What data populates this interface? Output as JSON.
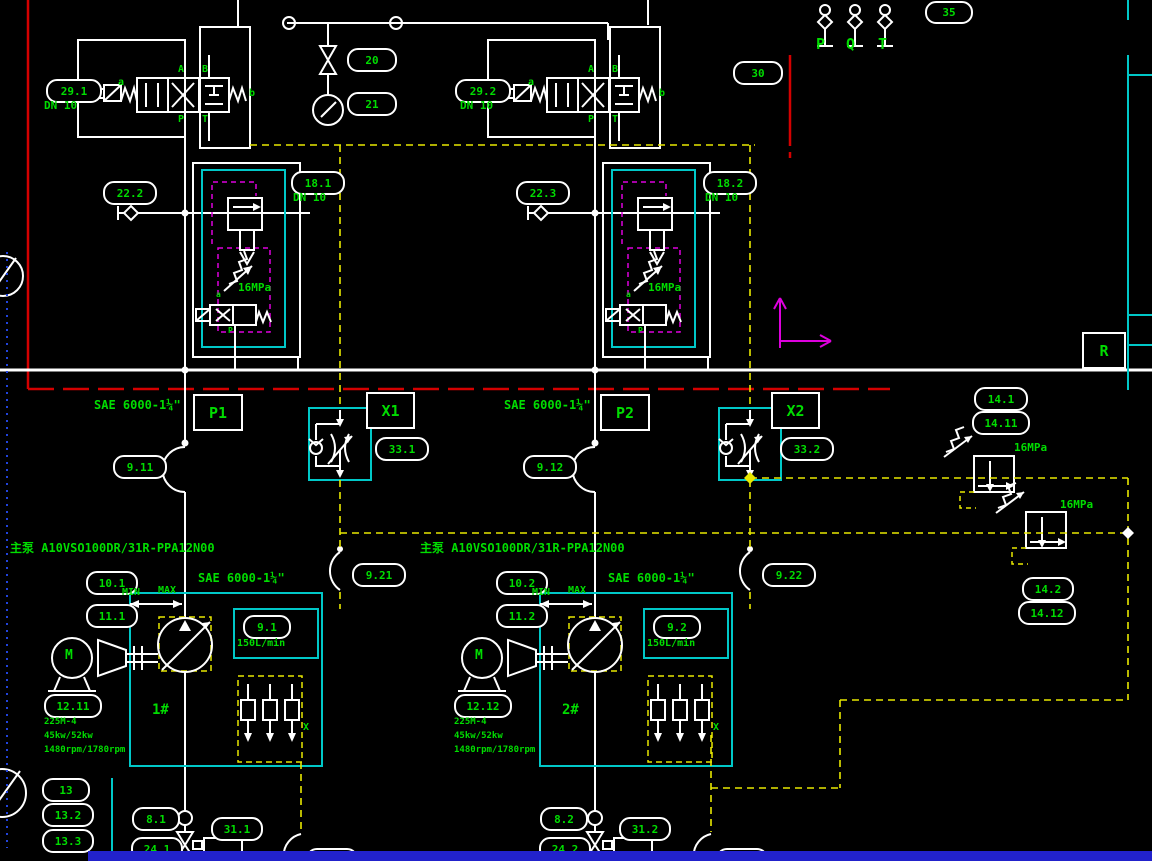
{
  "colors": {
    "background": "#000000",
    "line": "#ffffff",
    "label_green": "#00dd00",
    "cyan": "#00c8c8",
    "yellow": "#e8e800",
    "magenta": "#dd00dd",
    "red": "#d40000",
    "blue_bar": "#2222cc",
    "blue_dotted": "#2244dd"
  },
  "oval_tags": [
    {
      "id": "tag-29-1",
      "text": "29.1",
      "x": 46,
      "y": 79,
      "w": 52
    },
    {
      "id": "tag-20",
      "text": "20",
      "x": 347,
      "y": 48,
      "w": 46
    },
    {
      "id": "tag-21",
      "text": "21",
      "x": 347,
      "y": 92,
      "w": 46
    },
    {
      "id": "tag-29-2",
      "text": "29.2",
      "x": 455,
      "y": 79,
      "w": 52
    },
    {
      "id": "tag-30",
      "text": "30",
      "x": 733,
      "y": 61,
      "w": 46
    },
    {
      "id": "tag-35",
      "text": "35",
      "x": 925,
      "y": 1,
      "w": 44,
      "h": 19
    },
    {
      "id": "tag-22-2",
      "text": "22.2",
      "x": 103,
      "y": 181,
      "w": 50
    },
    {
      "id": "tag-18-1",
      "text": "18.1",
      "x": 291,
      "y": 171,
      "w": 50
    },
    {
      "id": "tag-22-3",
      "text": "22.3",
      "x": 516,
      "y": 181,
      "w": 50
    },
    {
      "id": "tag-18-2",
      "text": "18.2",
      "x": 703,
      "y": 171,
      "w": 50
    },
    {
      "id": "tag-14-1",
      "text": "14.1",
      "x": 974,
      "y": 387,
      "w": 50
    },
    {
      "id": "tag-14-11",
      "text": "14.11",
      "x": 972,
      "y": 411,
      "w": 54
    },
    {
      "id": "tag-33-1",
      "text": "33.1",
      "x": 375,
      "y": 437,
      "w": 50
    },
    {
      "id": "tag-33-2",
      "text": "33.2",
      "x": 780,
      "y": 437,
      "w": 50
    },
    {
      "id": "tag-9-11",
      "text": "9.11",
      "x": 113,
      "y": 455,
      "w": 50
    },
    {
      "id": "tag-9-12",
      "text": "9.12",
      "x": 523,
      "y": 455,
      "w": 50
    },
    {
      "id": "tag-9-21",
      "text": "9.21",
      "x": 352,
      "y": 563,
      "w": 50
    },
    {
      "id": "tag-9-22",
      "text": "9.22",
      "x": 762,
      "y": 563,
      "w": 50
    },
    {
      "id": "tag-10-1",
      "text": "10.1",
      "x": 86,
      "y": 571,
      "w": 48
    },
    {
      "id": "tag-11-1",
      "text": "11.1",
      "x": 86,
      "y": 604,
      "w": 48
    },
    {
      "id": "tag-10-2",
      "text": "10.2",
      "x": 496,
      "y": 571,
      "w": 48
    },
    {
      "id": "tag-11-2",
      "text": "11.2",
      "x": 496,
      "y": 604,
      "w": 48
    },
    {
      "id": "tag-9-1",
      "text": "9.1",
      "x": 243,
      "y": 615,
      "w": 44
    },
    {
      "id": "tag-9-2",
      "text": "9.2",
      "x": 653,
      "y": 615,
      "w": 44
    },
    {
      "id": "tag-12-11",
      "text": "12.11",
      "x": 44,
      "y": 694,
      "w": 54
    },
    {
      "id": "tag-12-12",
      "text": "12.12",
      "x": 454,
      "y": 694,
      "w": 54
    },
    {
      "id": "tag-14-2",
      "text": "14.2",
      "x": 1022,
      "y": 577,
      "w": 48
    },
    {
      "id": "tag-14-12",
      "text": "14.12",
      "x": 1018,
      "y": 601,
      "w": 54
    },
    {
      "id": "tag-13",
      "text": "13",
      "x": 42,
      "y": 778,
      "w": 44
    },
    {
      "id": "tag-13-2",
      "text": "13.2",
      "x": 42,
      "y": 803,
      "w": 48
    },
    {
      "id": "tag-13-3",
      "text": "13.3",
      "x": 42,
      "y": 829,
      "w": 48
    },
    {
      "id": "tag-8-1",
      "text": "8.1",
      "x": 132,
      "y": 807,
      "w": 44
    },
    {
      "id": "tag-24-1",
      "text": "24.1",
      "x": 131,
      "y": 837,
      "w": 48
    },
    {
      "id": "tag-31-1",
      "text": "31.1",
      "x": 211,
      "y": 817,
      "w": 48
    },
    {
      "id": "tag-8-2",
      "text": "8.2",
      "x": 540,
      "y": 807,
      "w": 44
    },
    {
      "id": "tag-24-2",
      "text": "24.2",
      "x": 539,
      "y": 837,
      "w": 48
    },
    {
      "id": "tag-31-2",
      "text": "31.2",
      "x": 619,
      "y": 817,
      "w": 48
    },
    {
      "id": "tag-34-1",
      "text": "34.1",
      "x": 306,
      "y": 848,
      "w": 48
    },
    {
      "id": "tag-34-2",
      "text": "34.2",
      "x": 716,
      "y": 848,
      "w": 48
    }
  ],
  "box_tags": [
    {
      "id": "port-p1",
      "text": "P1",
      "x": 193,
      "y": 394,
      "w": 46,
      "h": 33
    },
    {
      "id": "port-x1",
      "text": "X1",
      "x": 366,
      "y": 392,
      "w": 45,
      "h": 33
    },
    {
      "id": "port-p2",
      "text": "P2",
      "x": 600,
      "y": 394,
      "w": 46,
      "h": 33
    },
    {
      "id": "port-x2",
      "text": "X2",
      "x": 771,
      "y": 392,
      "w": 45,
      "h": 33
    },
    {
      "id": "port-r",
      "text": "R",
      "x": 1082,
      "y": 332,
      "w": 40,
      "h": 33
    }
  ],
  "green_texts": [
    {
      "id": "dn10-29-1",
      "text": "DN 10",
      "x": 44,
      "y": 100,
      "size": 11
    },
    {
      "id": "dn10-29-2",
      "text": "DN 10",
      "x": 460,
      "y": 100,
      "size": 11
    },
    {
      "id": "dn10-18-1",
      "text": "DN 10",
      "x": 293,
      "y": 192,
      "size": 11
    },
    {
      "id": "dn10-18-2",
      "text": "DN 10",
      "x": 705,
      "y": 192,
      "size": 11
    },
    {
      "id": "sae-p1",
      "text": "SAE 6000-1¼\"",
      "x": 94,
      "y": 399,
      "size": 12
    },
    {
      "id": "sae-p2",
      "text": "SAE 6000-1¼\"",
      "x": 504,
      "y": 399,
      "size": 12
    },
    {
      "id": "sae-s1",
      "text": "SAE 6000-1¼\"",
      "x": 198,
      "y": 572,
      "size": 12
    },
    {
      "id": "sae-s2",
      "text": "SAE 6000-1¼\"",
      "x": 608,
      "y": 572,
      "size": 12
    },
    {
      "id": "pump1-model",
      "text": "主泵 A10VSO100DR/31R-PPA12N00",
      "x": 10,
      "y": 542,
      "size": 12
    },
    {
      "id": "pump2-model",
      "text": "主泵 A10VSO100DR/31R-PPA12N00",
      "x": 420,
      "y": 542,
      "size": 12
    },
    {
      "id": "mpa-18-1",
      "text": "16MPa",
      "x": 238,
      "y": 282,
      "size": 11
    },
    {
      "id": "mpa-18-2",
      "text": "16MPa",
      "x": 648,
      "y": 282,
      "size": 11
    },
    {
      "id": "mpa-14-1",
      "text": "16MPa",
      "x": 1014,
      "y": 442,
      "size": 11
    },
    {
      "id": "mpa-14-2",
      "text": "16MPa",
      "x": 1060,
      "y": 499,
      "size": 11
    },
    {
      "id": "min-1",
      "text": "MIN",
      "x": 122,
      "y": 587,
      "size": 10
    },
    {
      "id": "max-1",
      "text": "MAX",
      "x": 158,
      "y": 585,
      "size": 10
    },
    {
      "id": "min-2",
      "text": "MIN",
      "x": 532,
      "y": 587,
      "size": 10
    },
    {
      "id": "max-2",
      "text": "MAX",
      "x": 568,
      "y": 585,
      "size": 10
    },
    {
      "id": "flow-1",
      "text": "150L/min",
      "x": 237,
      "y": 638,
      "size": 10
    },
    {
      "id": "flow-2",
      "text": "647L",
      "x": 647,
      "y": 638,
      "size": 10
    },
    {
      "id": "p-port",
      "text": "P",
      "x": 816,
      "y": 36,
      "size": 15
    },
    {
      "id": "q-port",
      "text": "Q",
      "x": 846,
      "y": 36,
      "size": 15
    },
    {
      "id": "t-port",
      "text": "T",
      "x": 878,
      "y": 36,
      "size": 15
    },
    {
      "id": "motor1-frame",
      "text": "225M-4",
      "x": 44,
      "y": 718,
      "size": 9
    },
    {
      "id": "motor1-power",
      "text": "45kw/52kw",
      "x": 44,
      "y": 732,
      "size": 9
    },
    {
      "id": "motor1-speed",
      "text": "1480rpm/1780rpm",
      "x": 44,
      "y": 746,
      "size": 9
    },
    {
      "id": "motor2-frame",
      "text": "225M-4",
      "x": 454,
      "y": 718,
      "size": 9
    },
    {
      "id": "motor2-power",
      "text": "45kw/52kw",
      "x": 454,
      "y": 732,
      "size": 9
    },
    {
      "id": "motor2-speed",
      "text": "1480rpm/1780rpm",
      "x": 454,
      "y": 746,
      "size": 9
    },
    {
      "id": "no-1",
      "text": "1#",
      "x": 152,
      "y": 703,
      "size": 14
    },
    {
      "id": "no-2",
      "text": "2#",
      "x": 562,
      "y": 703,
      "size": 14
    },
    {
      "id": "m-1",
      "text": "M",
      "x": 65,
      "y": 649,
      "size": 13
    },
    {
      "id": "m-2",
      "text": "M",
      "x": 475,
      "y": 649,
      "size": 13
    },
    {
      "id": "x-1",
      "text": "X",
      "x": 303,
      "y": 722,
      "size": 10
    },
    {
      "id": "x-2",
      "text": "X",
      "x": 713,
      "y": 722,
      "size": 10
    },
    {
      "id": "v1-a",
      "text": "A",
      "x": 178,
      "y": 64,
      "size": 10
    },
    {
      "id": "v1-b",
      "text": "B",
      "x": 202,
      "y": 64,
      "size": 10
    },
    {
      "id": "v1-p",
      "text": "P",
      "x": 178,
      "y": 114,
      "size": 10
    },
    {
      "id": "v1-t",
      "text": "T",
      "x": 202,
      "y": 114,
      "size": 10
    },
    {
      "id": "v1-sol-b",
      "text": "b",
      "x": 249,
      "y": 88,
      "size": 10
    },
    {
      "id": "v1-sol-a",
      "text": "a",
      "x": 118,
      "y": 77,
      "size": 10
    },
    {
      "id": "v2-a",
      "text": "A",
      "x": 588,
      "y": 64,
      "size": 10
    },
    {
      "id": "v2-b",
      "text": "B",
      "x": 612,
      "y": 64,
      "size": 10
    },
    {
      "id": "v2-p",
      "text": "P",
      "x": 588,
      "y": 114,
      "size": 10
    },
    {
      "id": "v2-t",
      "text": "T",
      "x": 612,
      "y": 114,
      "size": 10
    },
    {
      "id": "v2-sol-b",
      "text": "b",
      "x": 659,
      "y": 88,
      "size": 10
    },
    {
      "id": "v2-sol-a",
      "text": "a",
      "x": 528,
      "y": 77,
      "size": 10
    },
    {
      "id": "pl1-a",
      "text": "a",
      "x": 216,
      "y": 291,
      "size": 8
    },
    {
      "id": "pl1-p",
      "text": "P",
      "x": 228,
      "y": 327,
      "size": 8
    },
    {
      "id": "pl2-a",
      "text": "a",
      "x": 626,
      "y": 291,
      "size": 8
    },
    {
      "id": "pl2-p",
      "text": "P",
      "x": 638,
      "y": 327,
      "size": 8
    }
  ]
}
